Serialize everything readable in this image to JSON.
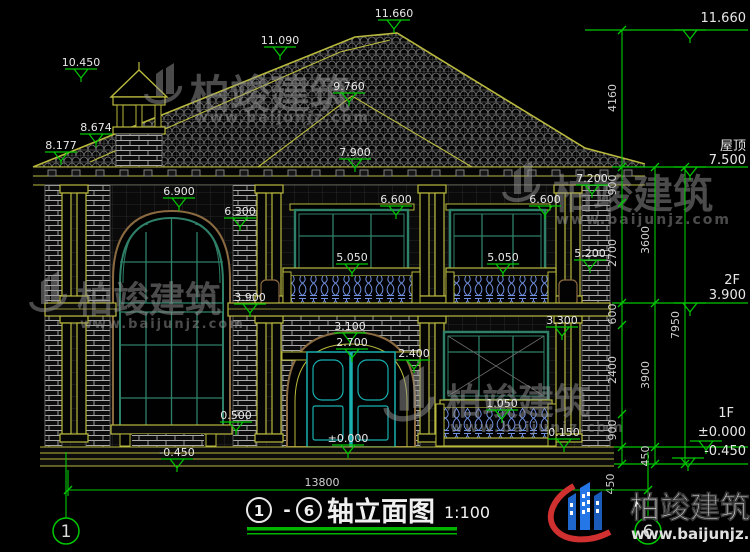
{
  "elev": {
    "chimney": "10.450",
    "ridge2": "11.090",
    "apex": "11.660",
    "hip": "9.760",
    "eaveL1": "8.674",
    "eaveL2": "8.177",
    "porch": "7.900",
    "eaveR": "7.200",
    "bandL": "6.900",
    "archTop": "6.300",
    "win2fL": "6.600",
    "win2fR": "6.600",
    "sill2fL": "5.050",
    "sill2fR": "5.050",
    "railR": "5.200",
    "transom": "3.900",
    "balcBase": "3.300",
    "entryArch": "3.100",
    "entryInner": "2.700",
    "pierCap": "2.400",
    "sill1fR": "1.050",
    "sill1fL": "0.500",
    "terrace": "0.150",
    "zero": "±0.000",
    "groundL": "-0.450"
  },
  "right_levels": {
    "top": "11.660",
    "roof_label": "屋顶",
    "roof": "7.500",
    "f2_label": "2F",
    "f2": "3.900",
    "f1_label": "1F",
    "f1_zero": "±0.000",
    "f1_ground": "-0.450"
  },
  "dims": {
    "a4160": "4160",
    "a900t": "900",
    "a2700": "2700",
    "a600": "600",
    "a2400": "2400",
    "a900b": "900",
    "a450": "450",
    "b3600": "3600",
    "b3900": "3900",
    "b450": "450",
    "c7950": "7950",
    "width": "13800"
  },
  "axes": {
    "left": "1",
    "right": "6"
  },
  "title": {
    "left_axis": "1",
    "separator": "-",
    "right_axis": "6",
    "name": "轴立面图",
    "scale": "1:100"
  },
  "watermark": {
    "name": "柏竣建筑",
    "site": "www.baijunjz.com"
  },
  "brand": {
    "name": "柏竣建筑",
    "site": "www.baijunjz.com"
  }
}
